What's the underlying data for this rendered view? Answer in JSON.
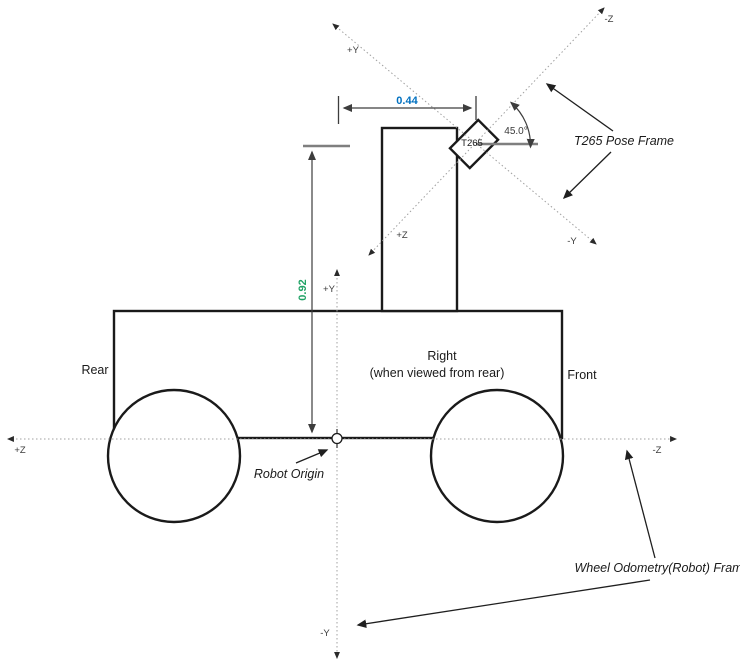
{
  "diagram": {
    "labels": {
      "rear": "Rear",
      "front": "Front",
      "side_line1": "Right",
      "side_line2": "(when viewed from rear)",
      "robot_origin": "Robot Origin",
      "sensor": "T265"
    },
    "annotations": {
      "t265_pose_frame": "T265 Pose Frame",
      "wheel_odometry_frame": "Wheel Odometry(Robot) Frame"
    },
    "dimensions": {
      "horizontal_offset_value": "0.44",
      "vertical_offset_value": "0.92",
      "tilt_angle_value": "45.0°"
    },
    "t265_frame_axes": {
      "up_left": "+Y",
      "up_right": "-Z",
      "down_left": "+Z",
      "down_right": "-Y"
    },
    "robot_frame_axes": {
      "left": "+Z",
      "right": "-Z",
      "up": "+Y",
      "down": "-Y"
    },
    "colors": {
      "horizontal_dim": "#0070C0",
      "vertical_dim": "#21A366"
    }
  }
}
